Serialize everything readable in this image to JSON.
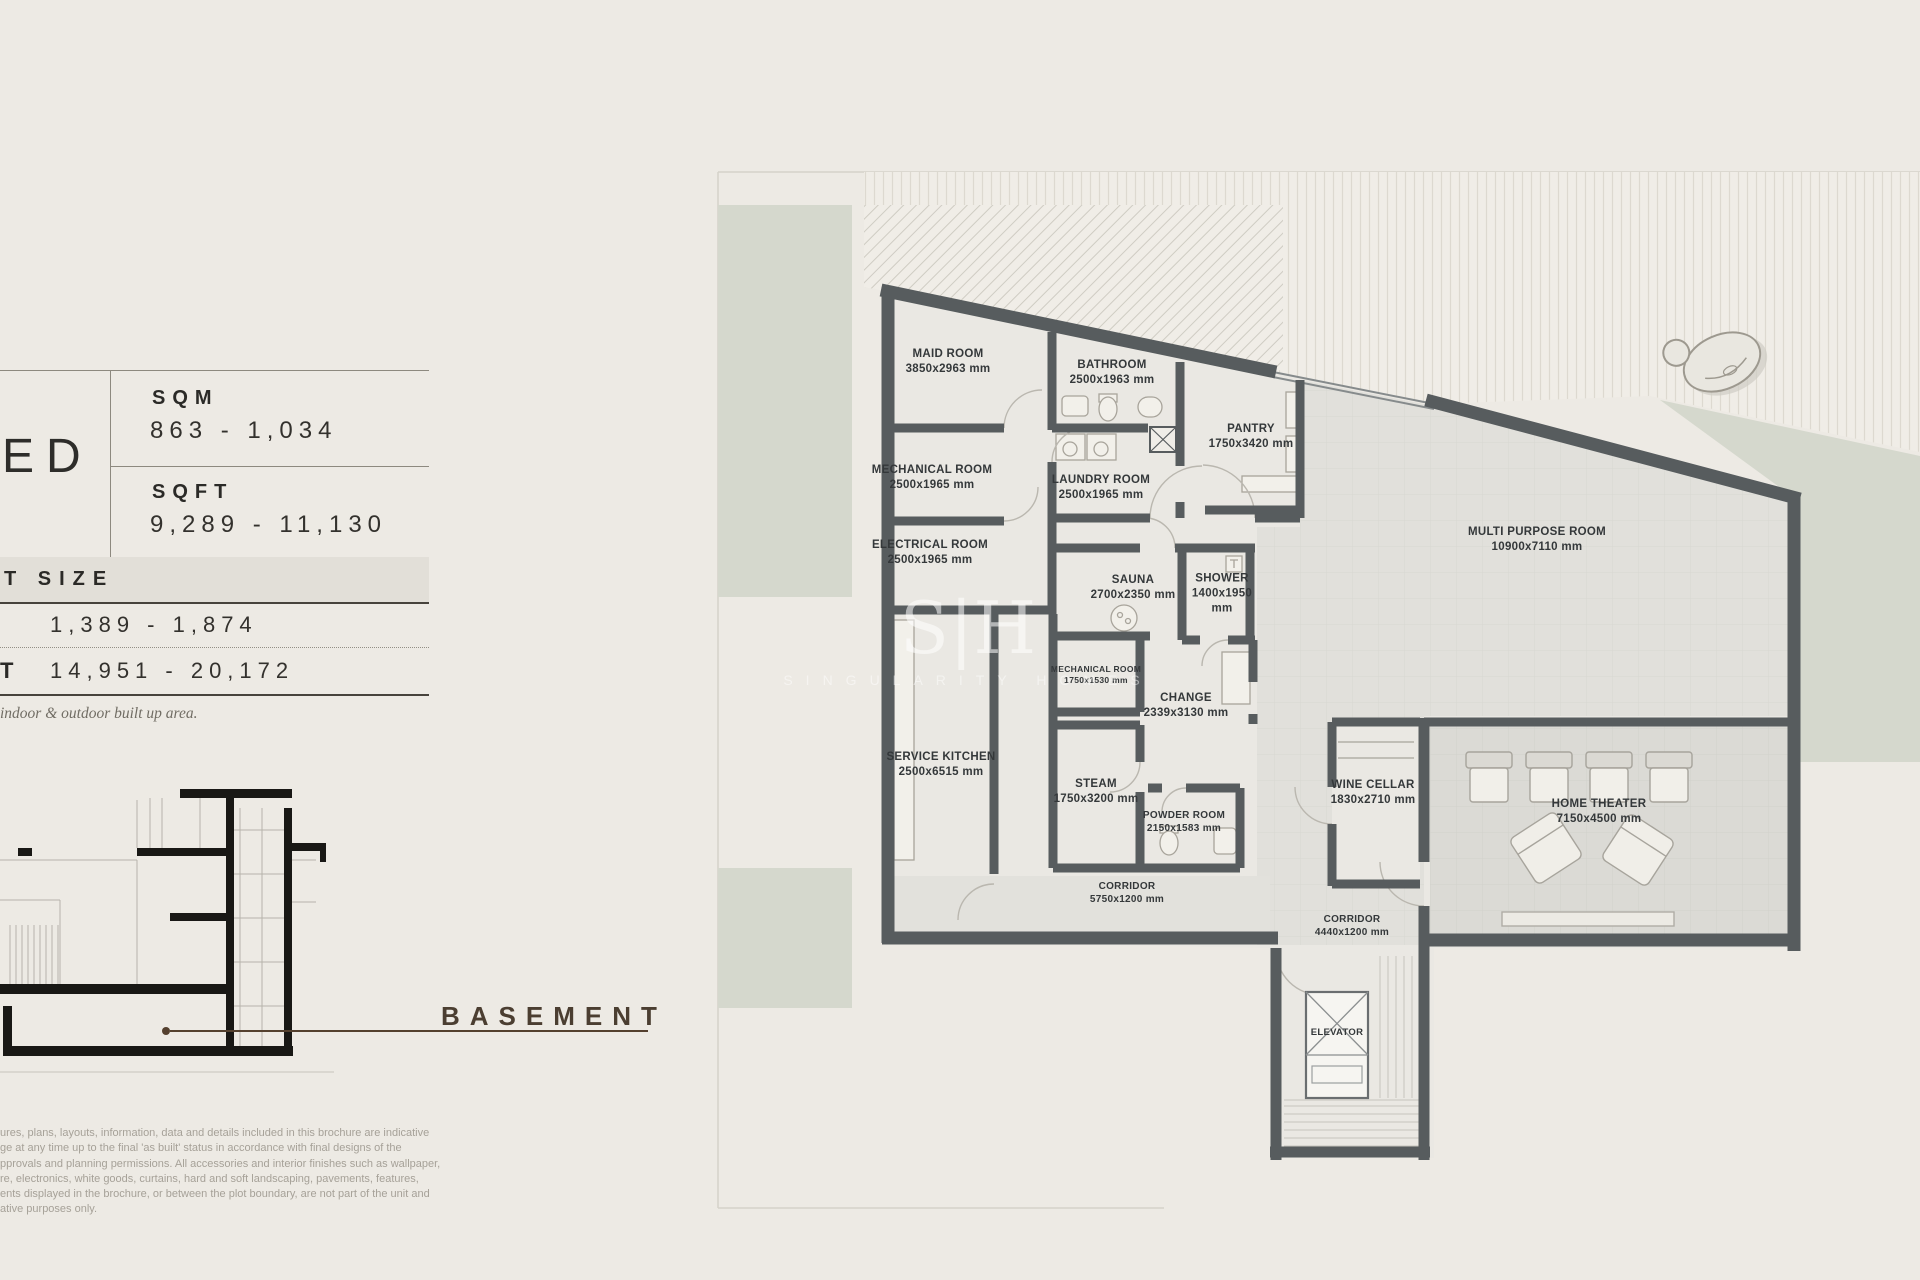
{
  "info": {
    "unit_label": "ED",
    "area_rows": [
      {
        "label": "SQM",
        "value": "863 - 1,034"
      },
      {
        "label": "SQFT",
        "value": "9,289 - 11,130"
      }
    ],
    "plot": {
      "header": "T SIZE",
      "sqm_value": "1,389 - 1,874",
      "sqft_prefix": "T",
      "sqft_value": "14,951 - 20,172"
    },
    "note": "indoor & outdoor built up area."
  },
  "section": {
    "label": "BASEMENT"
  },
  "disclaimer": {
    "lines": [
      "ures, plans, layouts, information, data and details included in this brochure are indicative",
      "ge at any time up to the final 'as built' status in accordance with final designs of the",
      "pprovals and planning permissions. All accessories and interior finishes such as wallpaper,",
      "re, electronics, white goods, curtains, hard and soft landscaping, pavements, features,",
      "ents displayed in the brochure, or between the plot boundary, are not part of the unit and",
      "ative purposes only."
    ]
  },
  "watermark": {
    "monogram": "S|H",
    "name": "SINGULARITY HOMES"
  },
  "plan": {
    "rooms": [
      {
        "name": "MAID ROOM",
        "dims": "3850x2963 mm"
      },
      {
        "name": "BATHROOM",
        "dims": "2500x1963 mm"
      },
      {
        "name": "PANTRY",
        "dims": "1750x3420 mm"
      },
      {
        "name": "MECHANICAL ROOM",
        "dims": "2500x1965 mm"
      },
      {
        "name": "LAUNDRY ROOM",
        "dims": "2500x1965 mm"
      },
      {
        "name": "ELECTRICAL ROOM",
        "dims": "2500x1965 mm"
      },
      {
        "name": "MULTI PURPOSE ROOM",
        "dims": "10900x7110 mm"
      },
      {
        "name": "SAUNA",
        "dims": "2700x2350 mm"
      },
      {
        "name": "SHOWER",
        "dims": "1400x1950 mm"
      },
      {
        "name": "MECHANICAL ROOM",
        "dims": "1750x1530 mm"
      },
      {
        "name": "CHANGE",
        "dims": "2339x3130 mm"
      },
      {
        "name": "SERVICE KITCHEN",
        "dims": "2500x6515 mm"
      },
      {
        "name": "STEAM",
        "dims": "1750x3200 mm"
      },
      {
        "name": "POWDER ROOM",
        "dims": "2150x1583 mm"
      },
      {
        "name": "WINE CELLAR",
        "dims": "1830x2710 mm"
      },
      {
        "name": "HOME THEATER",
        "dims": "7150x4500 mm"
      },
      {
        "name": "CORRIDOR",
        "dims": "5750x1200 mm"
      },
      {
        "name": "CORRIDOR",
        "dims": "4440x1200 mm"
      },
      {
        "name": "ELEVATOR",
        "dims": ""
      }
    ]
  },
  "colors": {
    "page_bg": "#edeae4",
    "wall_grey": "#575c5e",
    "landscape_green": "#d5d8cd",
    "accent_brown": "#54402e",
    "band_bg": "#e2dfd8"
  }
}
